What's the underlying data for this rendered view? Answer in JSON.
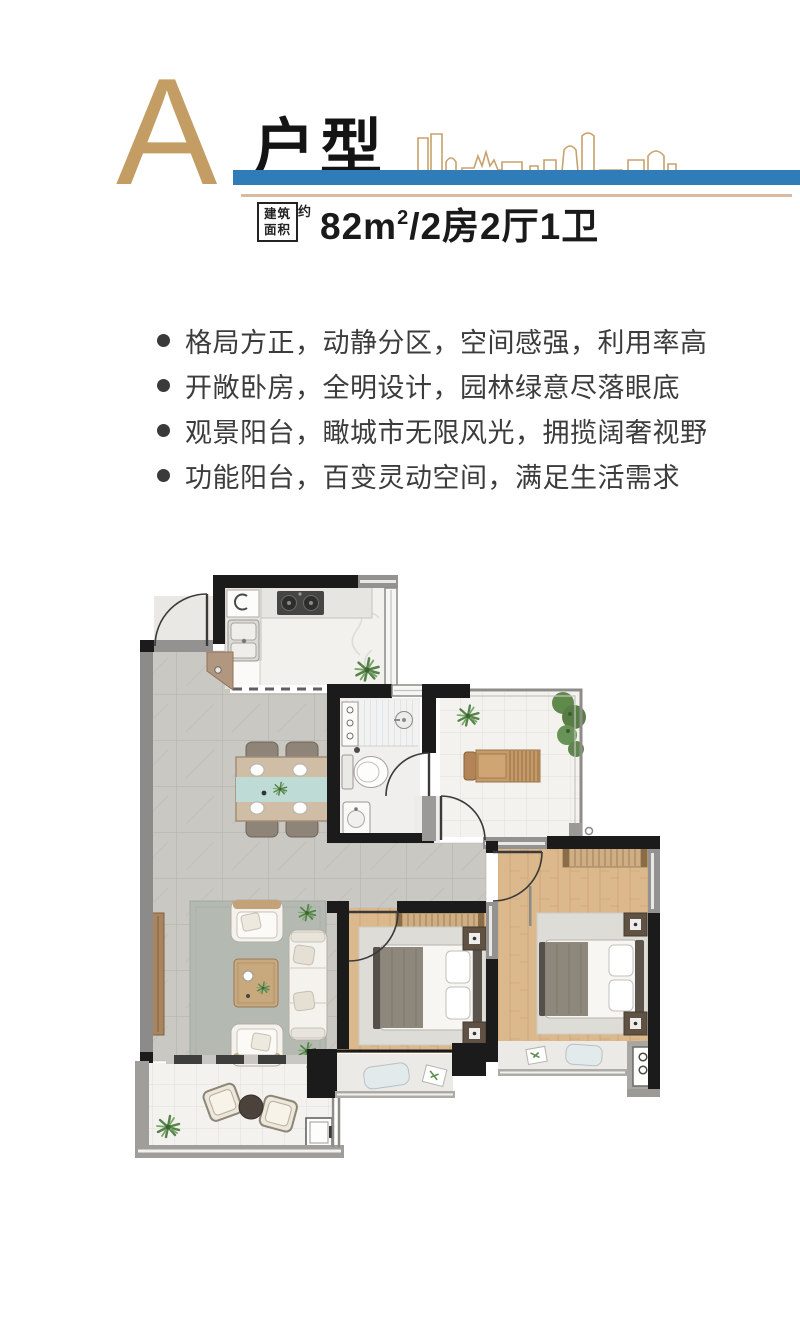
{
  "header": {
    "plan_letter": "A",
    "title": "户型",
    "area_badge_line1": "建筑",
    "area_badge_line2": "面积",
    "area_badge_approx": "约",
    "area_prefix": "82m",
    "area_sup": "2",
    "area_suffix": "/2房2厅1卫"
  },
  "features": [
    "格局方正，动静分区，空间感强，利用率高",
    "开敞卧房，全明设计，园林绿意尽落眼底",
    "观景阳台，瞰城市无限风光，拥揽阔奢视野",
    "功能阳台，百变灵动空间，满足生活需求"
  ],
  "colors": {
    "accent_tan": "#c49d65",
    "accent_blue": "#2f7cb9",
    "underline_tan": "#dcbaa1",
    "wall_black": "#1b1b1b",
    "wood_floor": "#dcb98d",
    "gray_tile": "#cac8c3"
  }
}
